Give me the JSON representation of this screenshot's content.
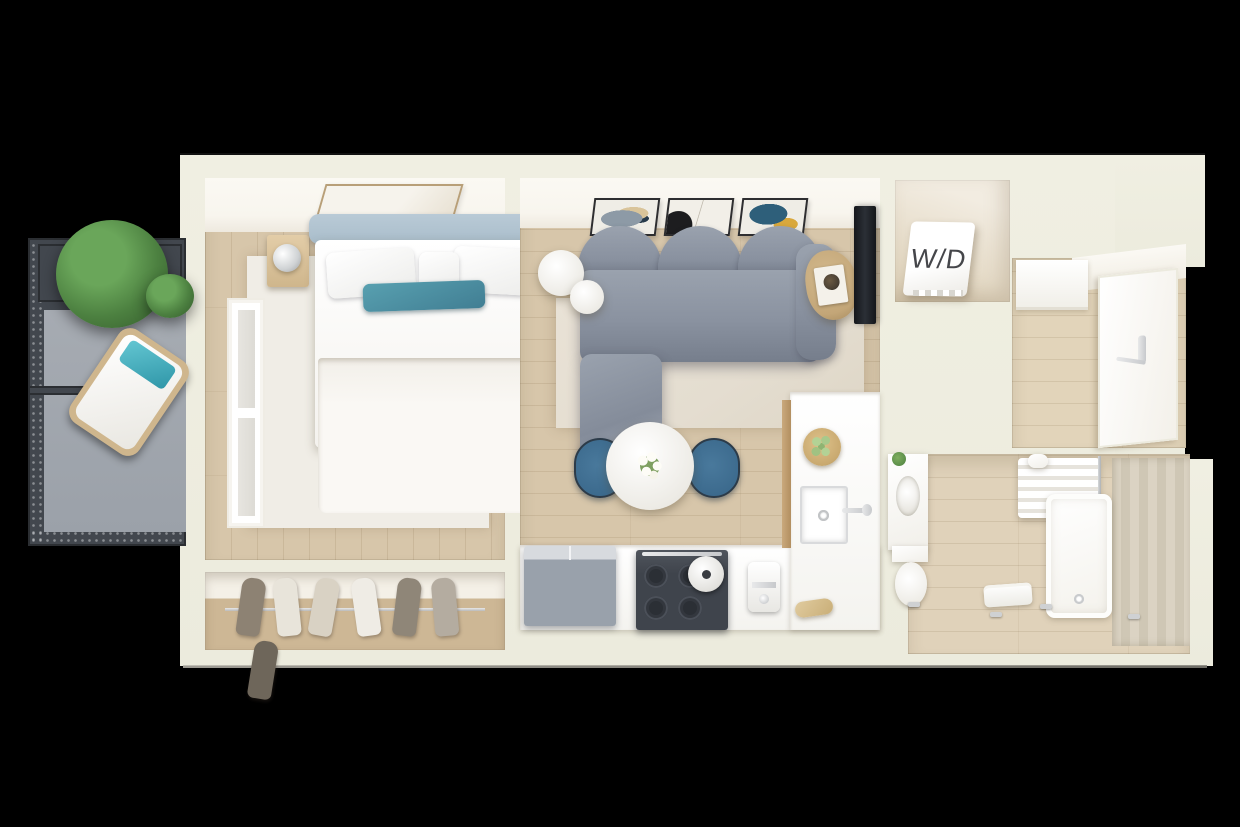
{
  "image_type": "3d-top-view-floorplan-render",
  "laundry": {
    "label": "W/D"
  },
  "colors": {
    "background": "#000000",
    "plan_shell": "#f0efe2",
    "wall_white": "#f8f5ee",
    "floor_wood": "#d7c6aa",
    "floor_wood_light": "#e2d4ba",
    "rug_living": "#e4ddd0",
    "rug_bedroom": "#f0ede6",
    "sofa_gray": "#8a92a0",
    "headboard_blue": "#a9bdcb",
    "pillow_teal": "#417e93",
    "chair_teal": "#3c6a8d",
    "balcony_frame": "#42474e",
    "balcony_deck": "#9ba1a9",
    "plant_green": "#4c8040",
    "appliance_dark": "#3f444c",
    "appliance_gray": "#99a1ab",
    "wood_accent": "#c3a678",
    "tile_beige": "#d7cfc0",
    "label_dark": "#45464a",
    "metal_silver": "#c7c9cc"
  },
  "rooms": [
    {
      "name": "balcony",
      "items": [
        "railing",
        "planter-tree",
        "shrub",
        "outdoor-lounge-chair",
        "deck-divider"
      ]
    },
    {
      "name": "bedroom",
      "items": [
        "wall-art",
        "double-bed",
        "headboard",
        "white-pillows",
        "teal-accent-pillow",
        "nightstand-left",
        "nightstand-right",
        "table-lamp-left",
        "table-lamp-right",
        "area-rug",
        "window"
      ]
    },
    {
      "name": "wardrobe-closet",
      "items": [
        "hanging-rail",
        "hanging-clothes"
      ]
    },
    {
      "name": "living-room",
      "items": [
        "gallery-frame-1",
        "gallery-frame-2",
        "gallery-frame-3",
        "sectional-sofa",
        "chaise",
        "round-side-table-large",
        "round-side-table-small",
        "wood-accent-table",
        "tv",
        "area-rug"
      ]
    },
    {
      "name": "dining-area",
      "items": [
        "round-dining-table",
        "flower-centerpiece",
        "teal-chair-left",
        "teal-chair-right"
      ]
    },
    {
      "name": "kitchen",
      "items": [
        "counter",
        "refrigerator",
        "range-cooktop",
        "cooking-pot",
        "coffee-machine",
        "cutting-board",
        "sink",
        "faucet",
        "fruit-bowl"
      ]
    },
    {
      "name": "laundry-closet",
      "items": [
        "washer-dryer-unit"
      ]
    },
    {
      "name": "entry-hall",
      "items": [
        "entry-door",
        "door-handle",
        "cabinet"
      ]
    },
    {
      "name": "bathroom",
      "items": [
        "vanity-sink",
        "toilet",
        "toilet-paper-holder",
        "shower-curtain",
        "curtain-rod",
        "bathtub",
        "shower-tiles",
        "towel",
        "floor-taps"
      ]
    }
  ]
}
